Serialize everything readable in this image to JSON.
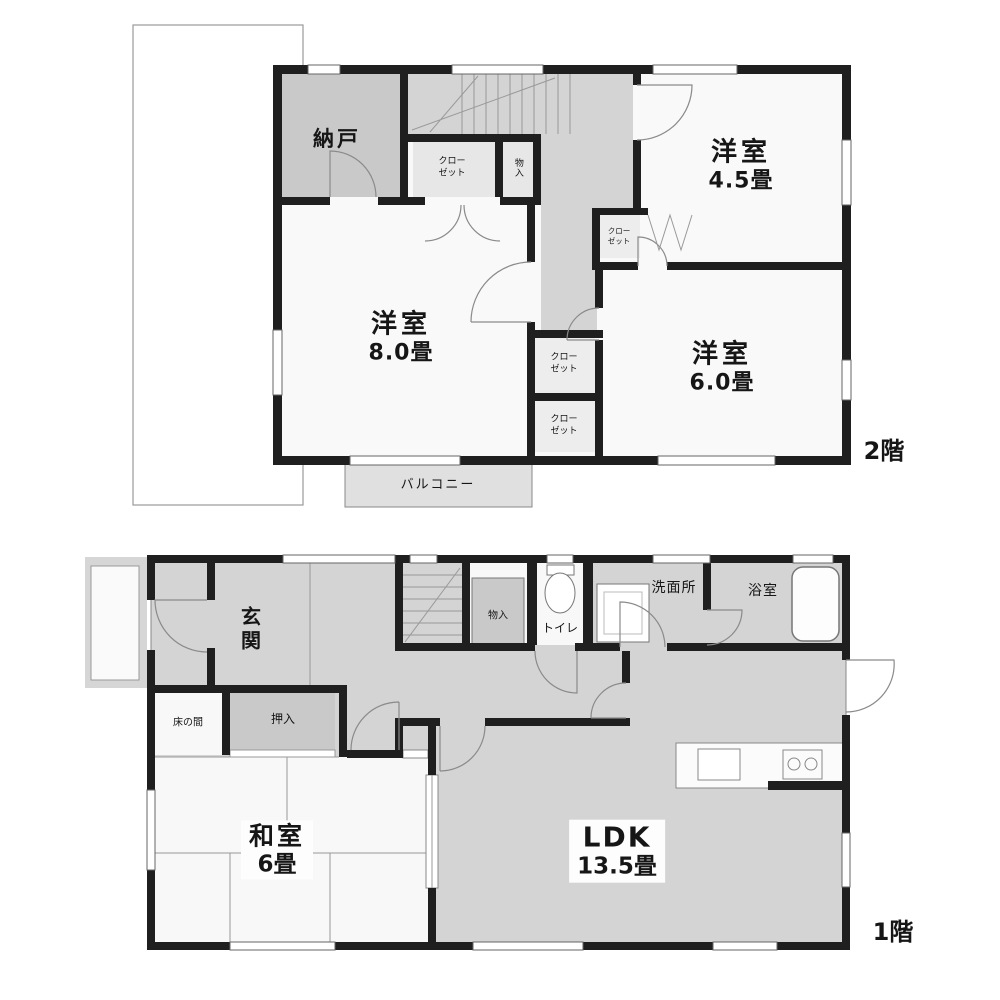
{
  "title": "間取り図",
  "colors": {
    "wall": "#1f1f1f",
    "room_gray": "#d4d4d4",
    "closet_gray": "#c9c9c9",
    "balcony_gray": "#e0e0e0",
    "white_room": "#fafafa"
  },
  "floor2": {
    "label": "2階",
    "rooms": {
      "nando": "納戸",
      "western1_name": "洋室",
      "western1_size": "4.5畳",
      "western2_name": "洋室",
      "western2_size": "8.0畳",
      "western3_name": "洋室",
      "western3_size": "6.0畳",
      "closet_line1": "クロー",
      "closet_line2": "ゼット",
      "storage": "物入",
      "balcony": "バルコニー"
    }
  },
  "floor1": {
    "label": "1階",
    "rooms": {
      "genkan": "玄関",
      "storage": "物入",
      "toilet": "トイレ",
      "washroom": "洗面所",
      "bathroom": "浴室",
      "tokonoma": "床の間",
      "oshiire": "押入",
      "japanese_name": "和室",
      "japanese_size": "6畳",
      "ldk_name": "LDK",
      "ldk_size": "13.5畳"
    }
  }
}
